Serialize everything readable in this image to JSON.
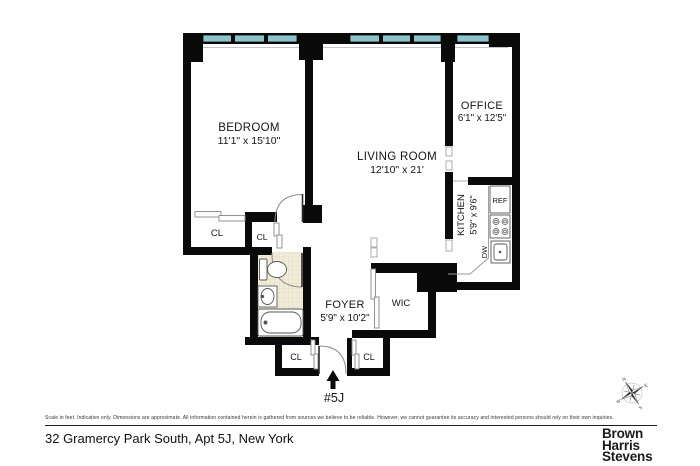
{
  "floorplan": {
    "rooms": {
      "bedroom": {
        "name": "BEDROOM",
        "dims": "11'1\" x 15'10\""
      },
      "living_room": {
        "name": "LIVING ROOM",
        "dims": "12'10\" x 21'"
      },
      "office": {
        "name": "OFFICE",
        "dims": "6'1\" x 12'5\""
      },
      "kitchen": {
        "name": "KITCHEN",
        "dims": "5'9\" x 9'6\""
      },
      "foyer": {
        "name": "FOYER",
        "dims": "5'9\" x 10'2\""
      },
      "wic": {
        "name": "WIC"
      }
    },
    "closet_label": "CL",
    "fixtures": {
      "refrigerator": "REF",
      "dishwasher": "DW"
    },
    "unit_label": "#5J",
    "compass": {
      "n": "N",
      "e": "E",
      "s": "S",
      "w": "W"
    },
    "colors": {
      "wall": "#0a0a0a",
      "window": "#8fc3cb",
      "tile": "#f1ecda"
    }
  },
  "footer": {
    "disclaimer": "Scale in feet. Indicative only. Dimensions are approximate. All information contained herein is gathered from sources we believe to be reliable. However, we cannot guarantee its accuracy and interested persons should rely on their own inquiries.",
    "address": "32 Gramercy Park South, Apt 5J, New York",
    "brand": {
      "line1": "Brown",
      "line2": "Harris",
      "line3": "Stevens"
    }
  }
}
